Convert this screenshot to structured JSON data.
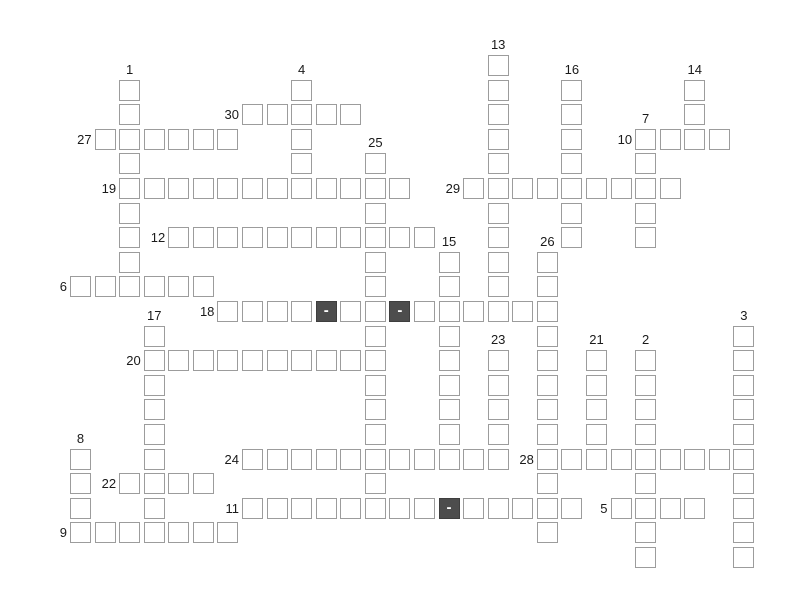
{
  "page": {
    "background": "#ffffff"
  },
  "grid": {
    "origin_x": 70,
    "origin_y": 55,
    "pitch_x": 24.57,
    "pitch_y": 24.6,
    "cell_size": 21,
    "cell_fill": "#ffffff",
    "cell_border_color": "#9c9c9c",
    "dark_cell_fill": "#4d4d4d",
    "dark_cell_border_color": "#3e3e3e",
    "dark_cell_text": "-",
    "dark_cell_text_color": "#ffffff",
    "number_color": "#1a1a1a",
    "words": {
      "across": [
        {
          "number": "30",
          "col": 7,
          "row": 2,
          "length": 5,
          "dark_offsets": []
        },
        {
          "number": "27",
          "col": 1,
          "row": 3,
          "length": 6,
          "dark_offsets": []
        },
        {
          "number": "10",
          "col": 23,
          "row": 3,
          "length": 4,
          "dark_offsets": []
        },
        {
          "number": "19",
          "col": 2,
          "row": 5,
          "length": 12,
          "dark_offsets": []
        },
        {
          "number": "29",
          "col": 16,
          "row": 5,
          "length": 9,
          "dark_offsets": []
        },
        {
          "number": "12",
          "col": 4,
          "row": 7,
          "length": 11,
          "dark_offsets": []
        },
        {
          "number": "6",
          "col": 0,
          "row": 9,
          "length": 6,
          "dark_offsets": []
        },
        {
          "number": "18",
          "col": 6,
          "row": 10,
          "length": 14,
          "dark_offsets": [
            4,
            7
          ]
        },
        {
          "number": "20",
          "col": 3,
          "row": 12,
          "length": 10,
          "dark_offsets": []
        },
        {
          "number": "24",
          "col": 7,
          "row": 16,
          "length": 11,
          "dark_offsets": []
        },
        {
          "number": "28",
          "col": 19,
          "row": 16,
          "length": 9,
          "dark_offsets": []
        },
        {
          "number": "22",
          "col": 2,
          "row": 17,
          "length": 4,
          "dark_offsets": []
        },
        {
          "number": "11",
          "col": 7,
          "row": 18,
          "length": 14,
          "dark_offsets": [
            8
          ]
        },
        {
          "number": "5",
          "col": 22,
          "row": 18,
          "length": 4,
          "dark_offsets": []
        },
        {
          "number": "9",
          "col": 0,
          "row": 19,
          "length": 7,
          "dark_offsets": []
        }
      ],
      "down": [
        {
          "number": "13",
          "col": 17,
          "row": 0,
          "length": 11,
          "dark_offsets": []
        },
        {
          "number": "1",
          "col": 2,
          "row": 1,
          "length": 9,
          "dark_offsets": []
        },
        {
          "number": "4",
          "col": 9,
          "row": 1,
          "length": 5,
          "dark_offsets": []
        },
        {
          "number": "16",
          "col": 20,
          "row": 1,
          "length": 7,
          "dark_offsets": []
        },
        {
          "number": "14",
          "col": 25,
          "row": 1,
          "length": 3,
          "dark_offsets": []
        },
        {
          "number": "7",
          "col": 23,
          "row": 3,
          "length": 5,
          "dark_offsets": []
        },
        {
          "number": "25",
          "col": 12,
          "row": 4,
          "length": 15,
          "dark_offsets": []
        },
        {
          "number": "15",
          "col": 15,
          "row": 8,
          "length": 9,
          "dark_offsets": []
        },
        {
          "number": "26",
          "col": 19,
          "row": 8,
          "length": 12,
          "dark_offsets": []
        },
        {
          "number": "17",
          "col": 3,
          "row": 11,
          "length": 9,
          "dark_offsets": []
        },
        {
          "number": "3",
          "col": 27,
          "row": 11,
          "length": 10,
          "dark_offsets": []
        },
        {
          "number": "23",
          "col": 17,
          "row": 12,
          "length": 5,
          "dark_offsets": []
        },
        {
          "number": "21",
          "col": 21,
          "row": 12,
          "length": 5,
          "dark_offsets": []
        },
        {
          "number": "2",
          "col": 23,
          "row": 12,
          "length": 9,
          "dark_offsets": []
        },
        {
          "number": "8",
          "col": 0,
          "row": 16,
          "length": 4,
          "dark_offsets": []
        }
      ]
    }
  }
}
